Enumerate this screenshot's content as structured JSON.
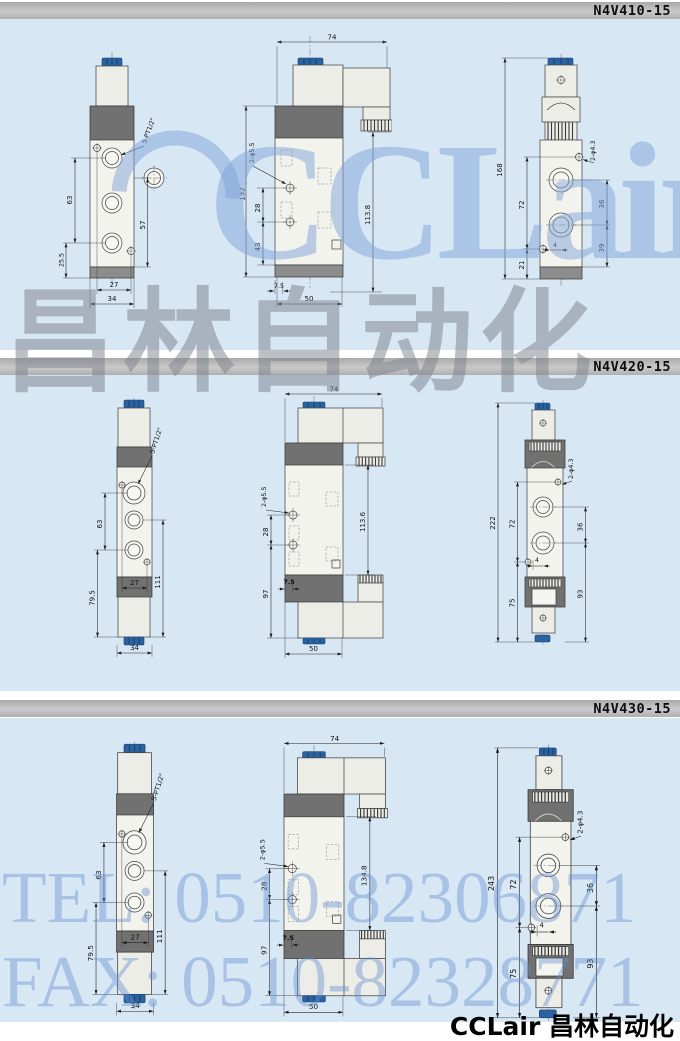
{
  "colors": {
    "section_bg": "#d7e7f4",
    "bar_gray": "#b8b8b8",
    "connector_blue": "#2a63a0",
    "body_light": "#f3f3ee",
    "band_dark": "#707070",
    "watermark_blue": "#7fa3d8",
    "watermark_gray": "#7e848d",
    "dimension_line": "#222222"
  },
  "watermarks": {
    "brand_latin": "CCLair",
    "brand_cn": "昌林自动化",
    "tel": "TEL: 0510-82306871",
    "fax": "FAX: 0510-82328771",
    "footer": "CCLair 昌林自动化"
  },
  "sections": [
    {
      "model": "N4V410-15",
      "front": {
        "port_label": "5-PT1/2\"",
        "d63": "63",
        "d25_5": "25.5",
        "d57": "57",
        "d27": "27",
        "d34": "34"
      },
      "side": {
        "d74": "74",
        "d132": "132",
        "hole_label": "2-φ5.5",
        "d28": "28",
        "d43": "43",
        "dheight": "113.8",
        "d7_5": "7.5",
        "d50": "50"
      },
      "end": {
        "dtotal": "168",
        "d72": "72",
        "d21": "21",
        "hole_label": "2-φ4.3",
        "d36": "36",
        "d39": "39",
        "d4": "4"
      }
    },
    {
      "model": "N4V420-15",
      "front": {
        "port_label": "5-PT1/2\"",
        "d63": "63",
        "d79_5": "79.5",
        "d27": "27",
        "d111": "111",
        "d34": "34"
      },
      "side": {
        "d74": "74",
        "hole_label": "2-φ5.5",
        "d28": "28",
        "d97": "97",
        "dheight": "113.6",
        "d7_5": "7.5",
        "d50": "50"
      },
      "end": {
        "dtotal": "222",
        "d72": "72",
        "d75": "75",
        "hole_label": "2-φ4.3",
        "d36": "36",
        "d93": "93",
        "d4": "4"
      }
    },
    {
      "model": "N4V430-15",
      "front": {
        "port_label": "5-PT1/2\"",
        "d63": "63",
        "d79_5": "79.5",
        "d27": "27",
        "d111": "111",
        "d34": "34"
      },
      "side": {
        "d74": "74",
        "hole_label": "2-φ5.5",
        "d28": "28",
        "d97": "97",
        "dheight": "134.8",
        "d7_5": "7.5",
        "d50": "50"
      },
      "end": {
        "dtotal": "243",
        "d72": "72",
        "d75": "75",
        "hole_label": "2-φ4.3",
        "d36": "36",
        "d93": "93",
        "d4": "4"
      }
    }
  ]
}
